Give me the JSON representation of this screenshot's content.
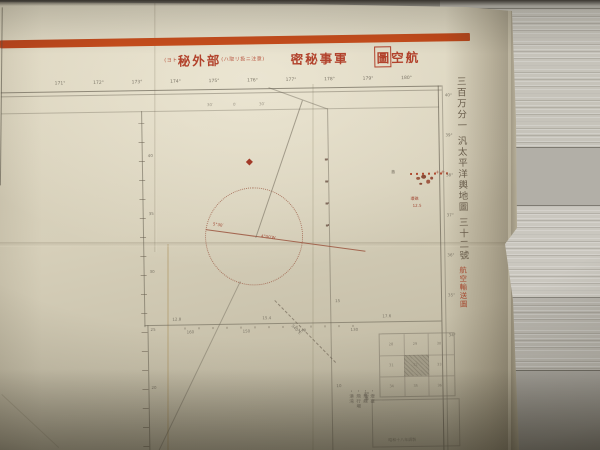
{
  "colors": {
    "paper": "#d9d2bd",
    "stripe_orange": "#c84d1c",
    "title_red": "#b2422c",
    "ink": "#7c7668",
    "island_red": "#b04a30",
    "wood": "#bdbab2"
  },
  "classification_row": {
    "segments": [
      {
        "text": "(ヨト",
        "size": "small",
        "boxed": false,
        "gap_before": false
      },
      {
        "text": "秘外部",
        "size": "large",
        "boxed": false,
        "gap_before": false
      },
      {
        "text": "(ハ取リ扱ニ注意)",
        "size": "small",
        "boxed": false,
        "gap_before": false
      },
      {
        "text": "密秘事軍",
        "size": "large",
        "boxed": false,
        "gap_before": true
      },
      {
        "text": "圖",
        "size": "large",
        "boxed": true,
        "gap_before": true
      },
      {
        "text": "空航",
        "size": "large",
        "boxed": false,
        "gap_before": false
      }
    ]
  },
  "side_title": {
    "main": "三百万分一 汎太平洋輿地圖 三十二號",
    "red_stamp": "航空輸送圖"
  },
  "top_ticks": [
    "171°",
    "172°",
    "173°",
    "174°",
    "175°",
    "176°",
    "177°",
    "178°",
    "179°",
    "180°"
  ],
  "inner_ticks": [
    "30′",
    "0′",
    "30′"
  ],
  "right_lat_labels": [
    "40°",
    "39°",
    "38°",
    "37°",
    "36°",
    "35°",
    "34°"
  ],
  "meridian1_labels": [
    "40",
    "35",
    "30",
    "25",
    "20"
  ],
  "meridian2_labels": [
    "15",
    "10"
  ],
  "parallel_above_labels": [
    "12.8",
    "15.4",
    "17.6"
  ],
  "parallel_below_labels": [
    "160",
    "150",
    "140",
    "130"
  ],
  "compass": {
    "variation_left": "5°30′",
    "variation_right": "4°00′W",
    "route_label": "S40°E"
  },
  "islands": {
    "dark_label": "島",
    "red_label": "環礁",
    "red_value": "12.5",
    "edge_marks": "+ +"
  },
  "index_map": {
    "cells": [
      "28",
      "29",
      "30",
      "31",
      "32",
      "33",
      "34",
      "35",
      "36"
    ],
    "current_index": 4
  },
  "note_box": {
    "side_label": "記事",
    "footer_text": "昭和十八年調製"
  },
  "legend_column": {
    "items": [
      "・燈臺",
      "・無線",
      "・飛行場",
      "・港湾"
    ]
  }
}
